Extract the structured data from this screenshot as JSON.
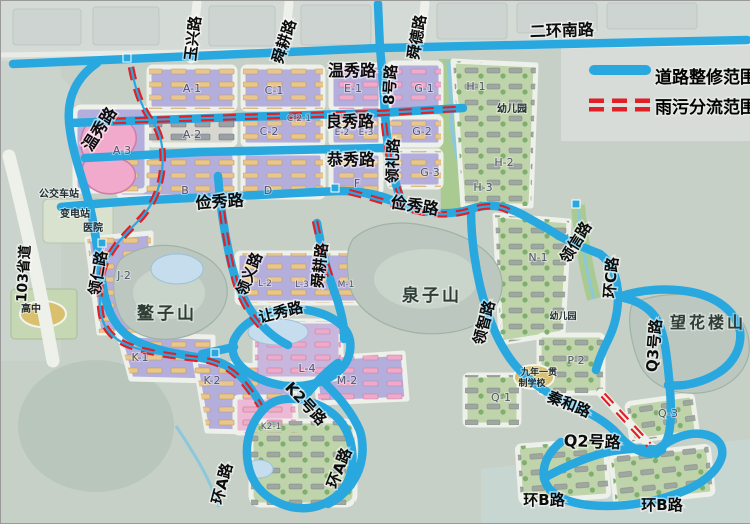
{
  "legend": {
    "items": [
      {
        "label": "道路整修范围",
        "type": "road-repair-line",
        "color": "#29a8e0"
      },
      {
        "label": "雨污分流范围",
        "type": "drainage-dashed-line",
        "color": "#e01f26"
      }
    ]
  },
  "colors": {
    "road_repair_blue": "#29a8e0",
    "drainage_red": "#e01f26",
    "block_purple": "#b3aedb",
    "block_pink": "#f1a9cc",
    "terrain": "#c6d0c7"
  },
  "map_labels": [
    {
      "k": "road",
      "t": "玉兴路",
      "x": 197,
      "y": 38,
      "r": -83
    },
    {
      "k": "road",
      "t": "舜耕路",
      "x": 288,
      "y": 42,
      "r": -72
    },
    {
      "k": "road",
      "t": "舜德路",
      "x": 421,
      "y": 37,
      "r": -80
    },
    {
      "k": "road",
      "t": "二环南路",
      "x": 561,
      "y": 35,
      "r": -2,
      "s": 16
    },
    {
      "k": "road",
      "t": "温秀路",
      "x": 351,
      "y": 75,
      "s": 16
    },
    {
      "k": "road",
      "t": "8号路",
      "x": 394,
      "y": 84,
      "r": -86
    },
    {
      "k": "road",
      "t": "良秀路",
      "x": 349,
      "y": 126,
      "s": 16
    },
    {
      "k": "road",
      "t": "恭秀路",
      "x": 350,
      "y": 164,
      "s": 16
    },
    {
      "k": "road",
      "t": "领礼路",
      "x": 397,
      "y": 160,
      "r": -88
    },
    {
      "k": "road",
      "t": "温秀路",
      "x": 103,
      "y": 131,
      "r": -57,
      "s": 16
    },
    {
      "k": "road",
      "t": "俭秀路",
      "x": 219,
      "y": 206,
      "r": -4,
      "s": 16
    },
    {
      "k": "road",
      "t": "俭秀路",
      "x": 413,
      "y": 210,
      "r": 9,
      "s": 16
    },
    {
      "k": "road",
      "t": "领仁路",
      "x": 102,
      "y": 273,
      "r": -80
    },
    {
      "k": "road",
      "t": "103省道",
      "x": 27,
      "y": 273,
      "r": -86,
      "s": 14
    },
    {
      "k": "road",
      "t": "领义路",
      "x": 253,
      "y": 275,
      "r": -68
    },
    {
      "k": "road",
      "t": "让秀路",
      "x": 281,
      "y": 316,
      "r": -14
    },
    {
      "k": "road",
      "t": "舜耕路",
      "x": 324,
      "y": 265,
      "r": -84
    },
    {
      "k": "road",
      "t": "领智路",
      "x": 488,
      "y": 323,
      "r": -75
    },
    {
      "k": "road",
      "t": "领信路",
      "x": 579,
      "y": 244,
      "r": -58
    },
    {
      "k": "road",
      "t": "环C路",
      "x": 615,
      "y": 277,
      "r": -85
    },
    {
      "k": "road",
      "t": "Q3号路",
      "x": 658,
      "y": 345,
      "r": -85
    },
    {
      "k": "road",
      "t": "秦和路",
      "x": 566,
      "y": 408,
      "r": 22
    },
    {
      "k": "road",
      "t": "Q2号路",
      "x": 591,
      "y": 446,
      "r": 2,
      "s": 16
    },
    {
      "k": "road",
      "t": "环B路",
      "x": 543,
      "y": 504
    },
    {
      "k": "road",
      "t": "环B路",
      "x": 661,
      "y": 509
    },
    {
      "k": "road",
      "t": "环A路",
      "x": 226,
      "y": 484,
      "r": -75
    },
    {
      "k": "road",
      "t": "环A路",
      "x": 343,
      "y": 469,
      "r": -68
    },
    {
      "k": "road",
      "t": "K2号路",
      "x": 301,
      "y": 406,
      "r": 47
    },
    {
      "k": "mountain",
      "t": "鳌子山",
      "x": 166,
      "y": 318
    },
    {
      "k": "mountain",
      "t": "泉子山",
      "x": 431,
      "y": 300
    },
    {
      "k": "mountain",
      "t": "望花楼山",
      "x": 707,
      "y": 327,
      "s": 16
    },
    {
      "k": "poi",
      "t": "公交车站",
      "x": 58,
      "y": 196
    },
    {
      "k": "poi",
      "t": "变电站",
      "x": 74,
      "y": 216
    },
    {
      "k": "poi",
      "t": "医院",
      "x": 92,
      "y": 230
    },
    {
      "k": "poi",
      "t": "高中",
      "x": 30,
      "y": 311
    },
    {
      "k": "poi",
      "t": "幼儿园",
      "x": 511,
      "y": 111
    },
    {
      "k": "poi",
      "t": "幼儿园",
      "x": 562,
      "y": 318,
      "s": 9
    },
    {
      "k": "poi",
      "t": "九年一贯",
      "x": 538,
      "y": 374,
      "s": 9
    },
    {
      "k": "poi",
      "t": "制学校",
      "x": 531,
      "y": 385,
      "s": 9
    },
    {
      "k": "block",
      "t": "A-1",
      "x": 191,
      "y": 91
    },
    {
      "k": "block",
      "t": "A-2",
      "x": 191,
      "y": 137
    },
    {
      "k": "block",
      "t": "A-3",
      "x": 121,
      "y": 153
    },
    {
      "k": "block",
      "t": "B",
      "x": 184,
      "y": 193
    },
    {
      "k": "block",
      "t": "C-1",
      "x": 273,
      "y": 93
    },
    {
      "k": "block",
      "t": "C-2-1",
      "x": 298,
      "y": 120,
      "s": 9
    },
    {
      "k": "block",
      "t": "C-2",
      "x": 268,
      "y": 134
    },
    {
      "k": "block",
      "t": "D",
      "x": 267,
      "y": 193
    },
    {
      "k": "block",
      "t": "E-1",
      "x": 352,
      "y": 91
    },
    {
      "k": "block",
      "t": "E-2",
      "x": 341,
      "y": 134,
      "s": 9
    },
    {
      "k": "block",
      "t": "E-3",
      "x": 365,
      "y": 134,
      "s": 9
    },
    {
      "k": "block",
      "t": "F",
      "x": 356,
      "y": 186
    },
    {
      "k": "block",
      "t": "G-1",
      "x": 423,
      "y": 91
    },
    {
      "k": "block",
      "t": "G-2",
      "x": 421,
      "y": 134
    },
    {
      "k": "block",
      "t": "G-3",
      "x": 429,
      "y": 175
    },
    {
      "k": "block",
      "t": "H-1",
      "x": 475,
      "y": 89
    },
    {
      "k": "block",
      "t": "H-2",
      "x": 503,
      "y": 165
    },
    {
      "k": "block",
      "t": "H-3",
      "x": 482,
      "y": 190
    },
    {
      "k": "block",
      "t": "J-2",
      "x": 123,
      "y": 278
    },
    {
      "k": "block",
      "t": "K-1",
      "x": 139,
      "y": 360
    },
    {
      "k": "block",
      "t": "K-2",
      "x": 211,
      "y": 383
    },
    {
      "k": "block",
      "t": "K2-1",
      "x": 270,
      "y": 428,
      "s": 9
    },
    {
      "k": "block",
      "t": "L-2",
      "x": 264,
      "y": 285,
      "s": 9
    },
    {
      "k": "block",
      "t": "L-3",
      "x": 301,
      "y": 286,
      "s": 9
    },
    {
      "k": "block",
      "t": "L-4",
      "x": 306,
      "y": 371
    },
    {
      "k": "block",
      "t": "M-1",
      "x": 345,
      "y": 286,
      "s": 9
    },
    {
      "k": "block",
      "t": "M-2",
      "x": 346,
      "y": 383
    },
    {
      "k": "block",
      "t": "N-1",
      "x": 537,
      "y": 260
    },
    {
      "k": "block",
      "t": "P-2",
      "x": 575,
      "y": 363
    },
    {
      "k": "block",
      "t": "Q-1",
      "x": 500,
      "y": 400
    },
    {
      "k": "block",
      "t": "Q-3",
      "x": 667,
      "y": 416
    }
  ]
}
